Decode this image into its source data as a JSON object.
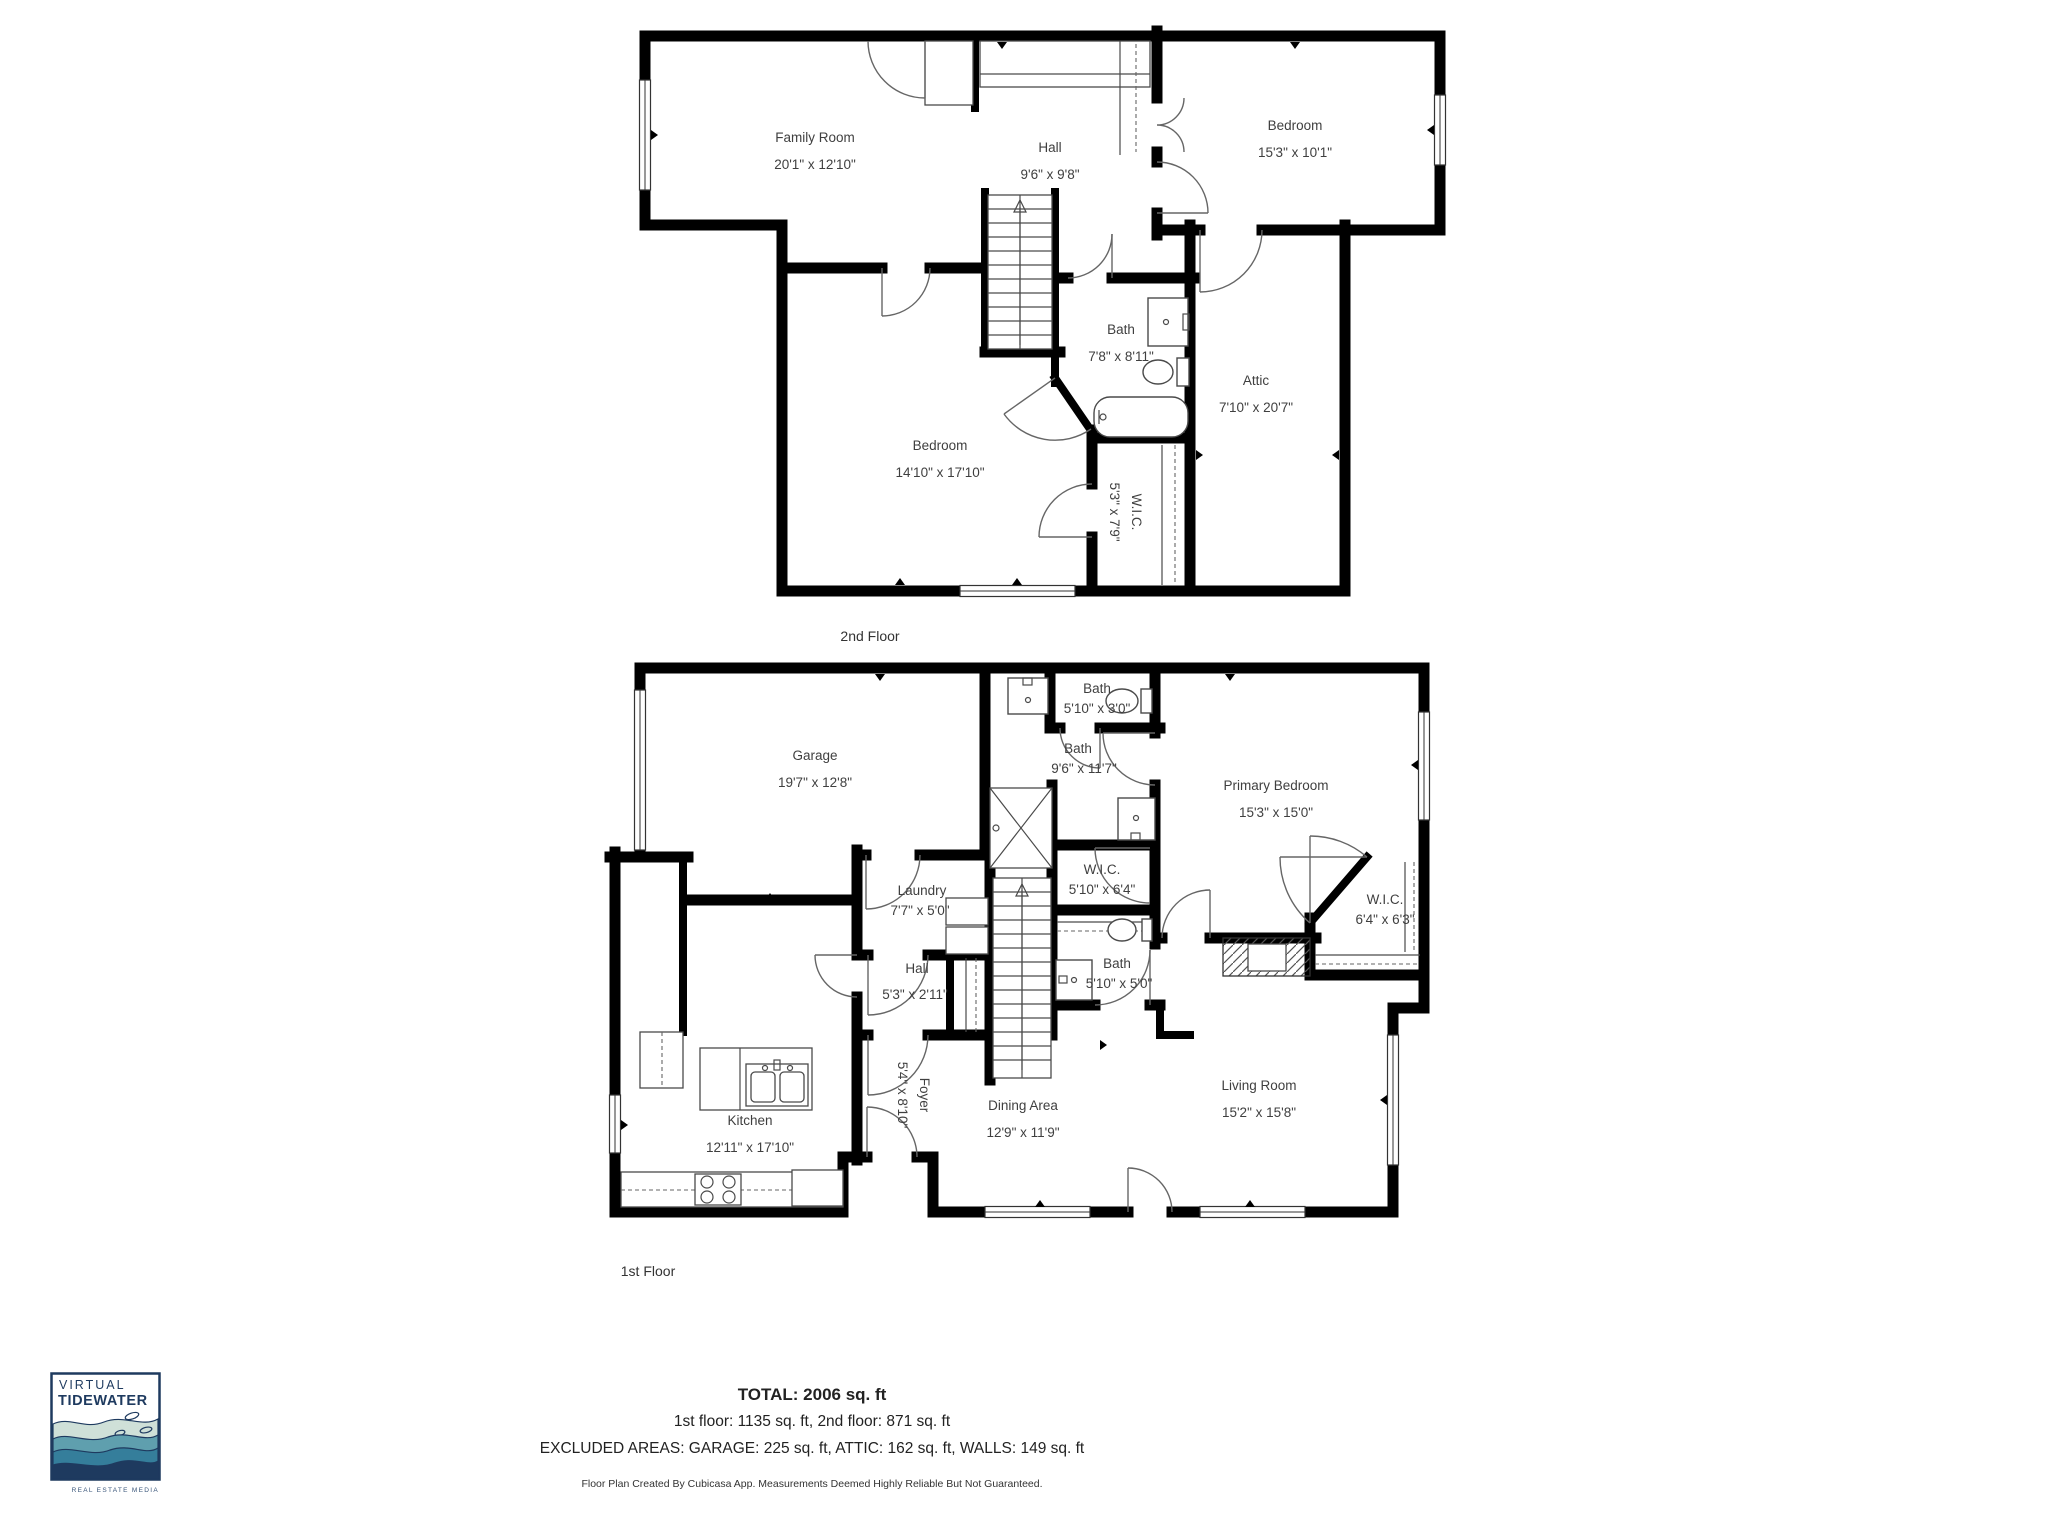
{
  "second_floor": {
    "caption": "2nd Floor",
    "rooms": {
      "family_room": {
        "name": "Family Room",
        "dims": "20'1\" x 12'10\""
      },
      "hall": {
        "name": "Hall",
        "dims": "9'6\" x 9'8\""
      },
      "bedroom_right": {
        "name": "Bedroom",
        "dims": "15'3\" x 10'1\""
      },
      "bath": {
        "name": "Bath",
        "dims": "7'8\" x 8'11\""
      },
      "attic": {
        "name": "Attic",
        "dims": "7'10\" x 20'7\""
      },
      "bedroom_main": {
        "name": "Bedroom",
        "dims": "14'10\" x 17'10\""
      },
      "wic": {
        "name": "W.I.C.",
        "dims": "5'3\" x 7'9\""
      }
    }
  },
  "first_floor": {
    "caption": "1st Floor",
    "rooms": {
      "garage": {
        "name": "Garage",
        "dims": "19'7\" x 12'8\""
      },
      "bath_small": {
        "name": "Bath",
        "dims": "5'10\" x 3'0\""
      },
      "bath_primary": {
        "name": "Bath",
        "dims": "9'6\" x 11'7\""
      },
      "primary_bedroom": {
        "name": "Primary Bedroom",
        "dims": "15'3\" x 15'0\""
      },
      "laundry": {
        "name": "Laundry",
        "dims": "7'7\" x 5'0\""
      },
      "wic_hall": {
        "name": "W.I.C.",
        "dims": "5'10\" x 6'4\""
      },
      "hall": {
        "name": "Hall",
        "dims": "5'3\" x 2'11\""
      },
      "bath_hall": {
        "name": "Bath",
        "dims": "5'10\" x 5'0\""
      },
      "wic_primary": {
        "name": "W.I.C.",
        "dims": "6'4\" x 6'3\""
      },
      "foyer": {
        "name": "Foyer",
        "dims": "5'4\" x 8'10\""
      },
      "kitchen": {
        "name": "Kitchen",
        "dims": "12'11\" x 17'10\""
      },
      "dining": {
        "name": "Dining Area",
        "dims": "12'9\" x 11'9\""
      },
      "living": {
        "name": "Living Room",
        "dims": "15'2\" x 15'8\""
      }
    }
  },
  "summary": {
    "total": "TOTAL: 2006 sq. ft",
    "floors": "1st floor: 1135 sq. ft, 2nd floor: 871 sq. ft",
    "excluded": "EXCLUDED AREAS: GARAGE: 225 sq. ft, ATTIC: 162 sq. ft, WALLS: 149 sq. ft",
    "disclaimer": "Floor Plan Created By Cubicasa App. Measurements Deemed Highly Reliable But Not Guaranteed."
  },
  "logo": {
    "line1": "VIRTUAL",
    "line2": "TIDEWATER",
    "tagline": "REAL ESTATE MEDIA"
  },
  "colors": {
    "wall": "#000000",
    "label": "#3f3f3f",
    "logo_navy": "#1e3a5f",
    "wave_light": "#cfe0d8",
    "wave_teal": "#5f9fae",
    "wave_mid": "#357e9b",
    "wave_deep": "#1e3a5f"
  }
}
